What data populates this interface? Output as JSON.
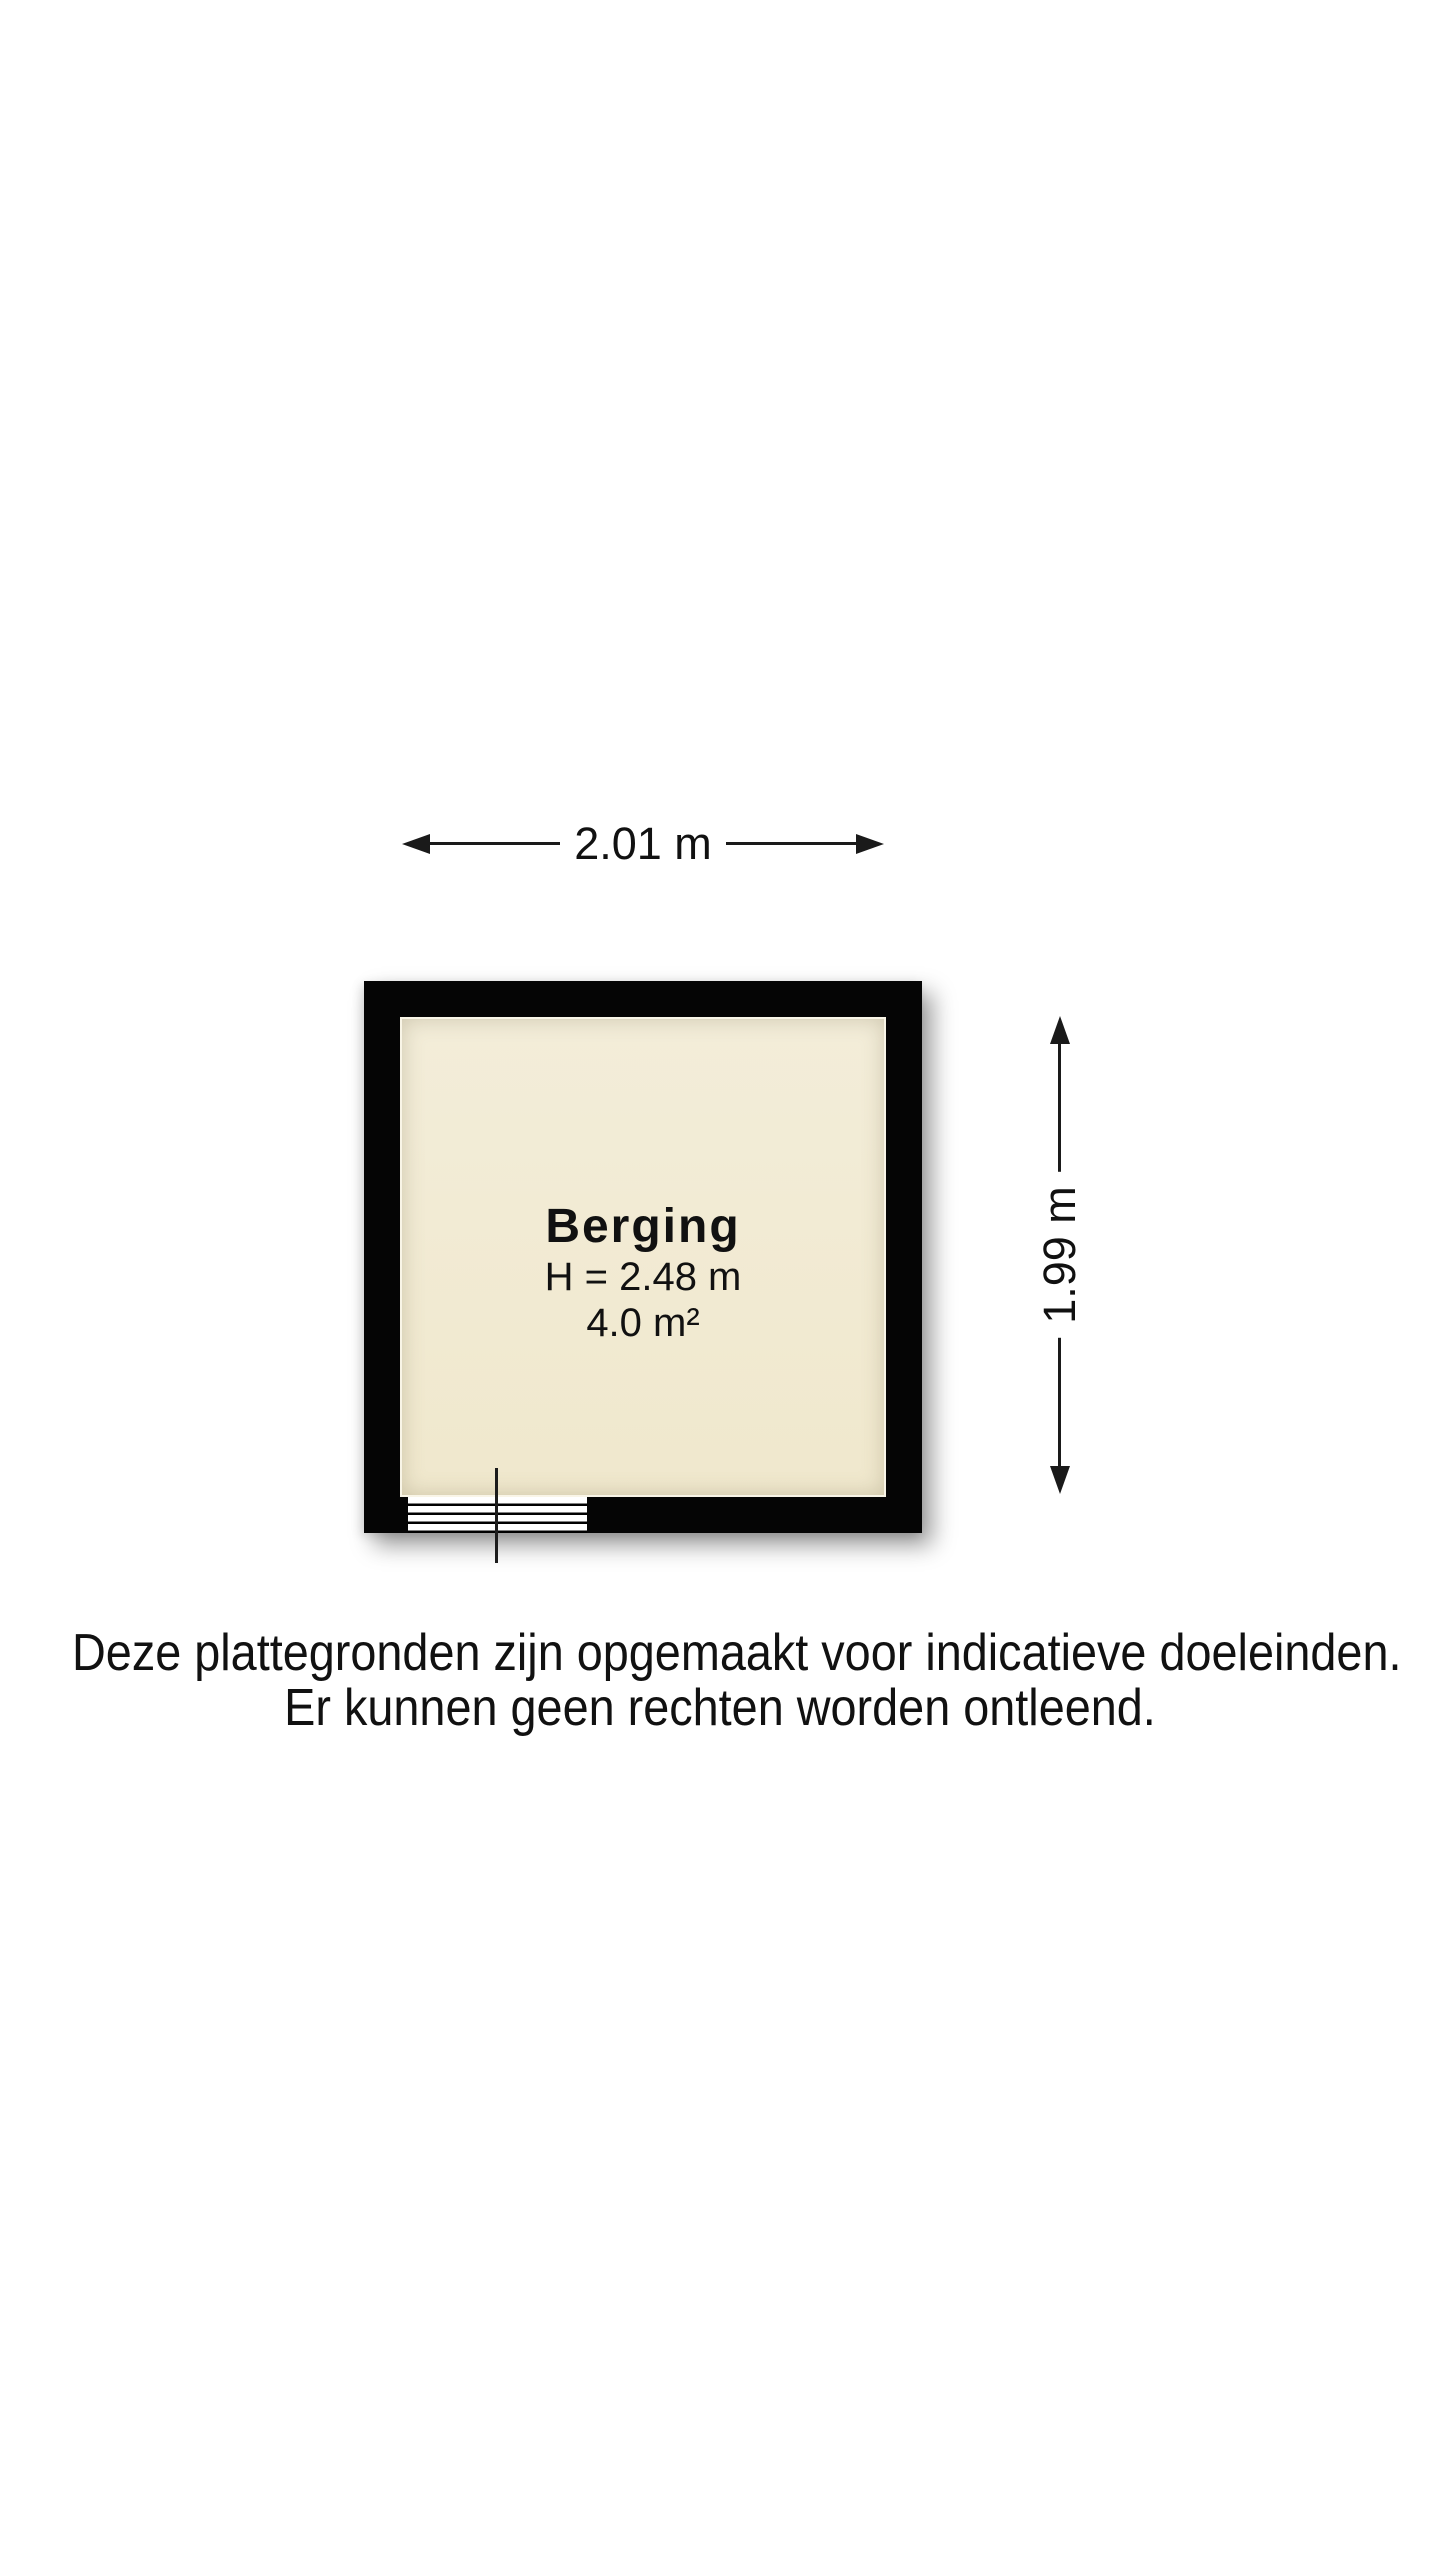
{
  "floorplan": {
    "room": {
      "name": "Berging",
      "ceiling_height": "H = 2.48 m",
      "area": "4.0 m²"
    },
    "dimensions": {
      "width": "2.01 m",
      "height": "1.99 m"
    },
    "colors": {
      "wall": "#050505",
      "floor": "#f1ead3",
      "dimension_line": "#1a1a1a",
      "background": "#ffffff"
    }
  },
  "disclaimer": {
    "line1": "Deze plattegronden zijn opgemaakt voor indicatieve doeleinden.",
    "line2": "Er kunnen geen rechten worden ontleend."
  }
}
